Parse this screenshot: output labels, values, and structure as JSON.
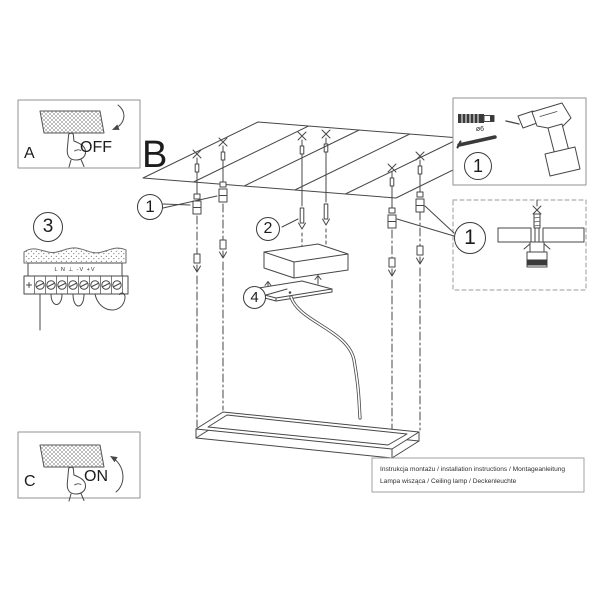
{
  "colors": {
    "background": "#ffffff",
    "line": "#474747",
    "panel_border": "#909090",
    "dark_fill": "#3a3a3a",
    "text": "#1c1c1c"
  },
  "panel_a": {
    "letter": "A",
    "state_label": "OFF"
  },
  "panel_c": {
    "letter": "C",
    "state_label": "ON"
  },
  "main": {
    "letter": "B"
  },
  "callouts": {
    "hangers": "1",
    "parts_kit": "1",
    "anchor_detail": "1",
    "mounting_screws": "2",
    "wiring": "3",
    "canopy_cover": "4"
  },
  "parts_kit": {
    "anchor_diameter": "ø6"
  },
  "wiring": {
    "terminal_labels": "L N ⊥ -V +V"
  },
  "footer": {
    "line1": "Instrukcja montażu / installation instructions / Montageanleitung",
    "line2": "Lampa wisząca / Ceiling lamp / Deckenleuchte"
  }
}
